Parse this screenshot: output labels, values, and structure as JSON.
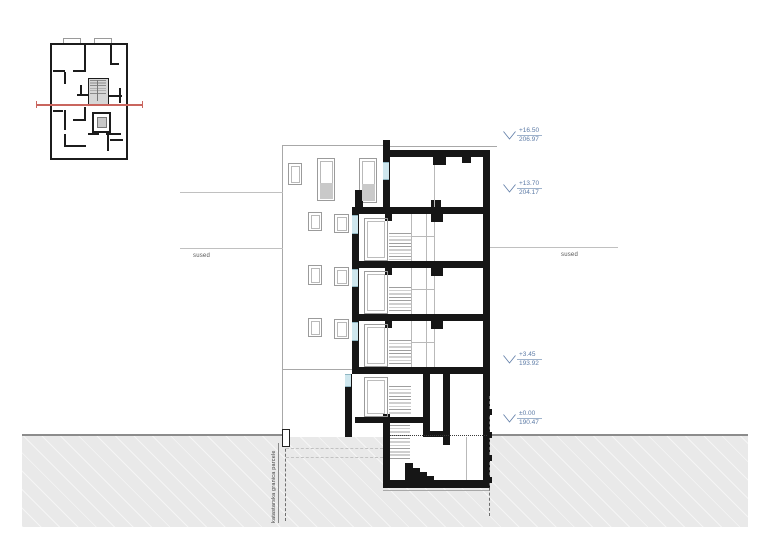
{
  "annotations": {
    "neighbor_left": "sused",
    "neighbor_right": "sused",
    "boundary_label": "katastarska granica parcele",
    "levels": [
      {
        "rel": "+16.50",
        "abs": "206.97"
      },
      {
        "rel": "+13.70",
        "abs": "204.17"
      },
      {
        "rel": "+3.45",
        "abs": "193.92"
      },
      {
        "rel": "±0.00",
        "abs": "190.47"
      }
    ]
  },
  "colors": {
    "annotation_blue": "#5d7ba6",
    "section_red": "#c9655e",
    "wall_black": "#161616",
    "terrain_gray": "#e9e9e9",
    "line_gray": "#9a9a9a",
    "glazing_blue": "#cfe7ee"
  }
}
